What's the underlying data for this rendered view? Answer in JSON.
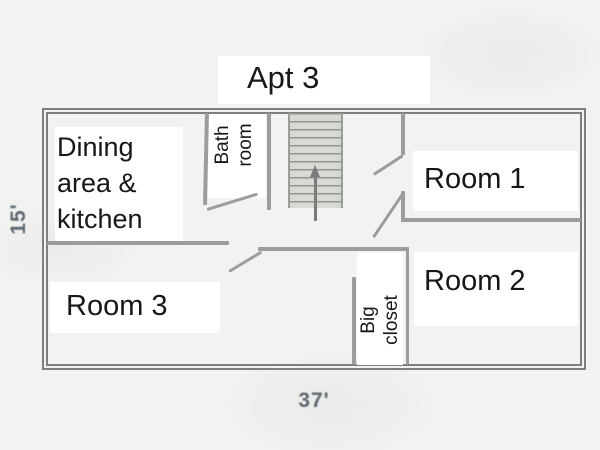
{
  "title": "Apt 3",
  "dimensions": {
    "height_label": "15'",
    "width_label": "37'"
  },
  "rooms": {
    "dining": {
      "line1": "Dining",
      "line2": "area &",
      "line3": "kitchen"
    },
    "bathroom": {
      "line1": "Bath",
      "line2": "room"
    },
    "room1": {
      "label": "Room 1"
    },
    "room2": {
      "label": "Room 2"
    },
    "room3": {
      "label": "Room 3"
    },
    "closet": {
      "line1": "Big",
      "line2": "closet"
    }
  },
  "features": {
    "staircase": "staircase with up-direction arrow",
    "doors": [
      "bathroom-door",
      "room1-door",
      "room2-door",
      "room3-door"
    ]
  },
  "colors": {
    "background": "#f2f3f1",
    "wall_outer": "#7e7e7e",
    "wall_inner": "#9c9c9c",
    "stair_fill": "#d6dad3",
    "stair_tread": "#8f948d",
    "label_text": "#171717",
    "dimension_text": "#5f6771"
  }
}
